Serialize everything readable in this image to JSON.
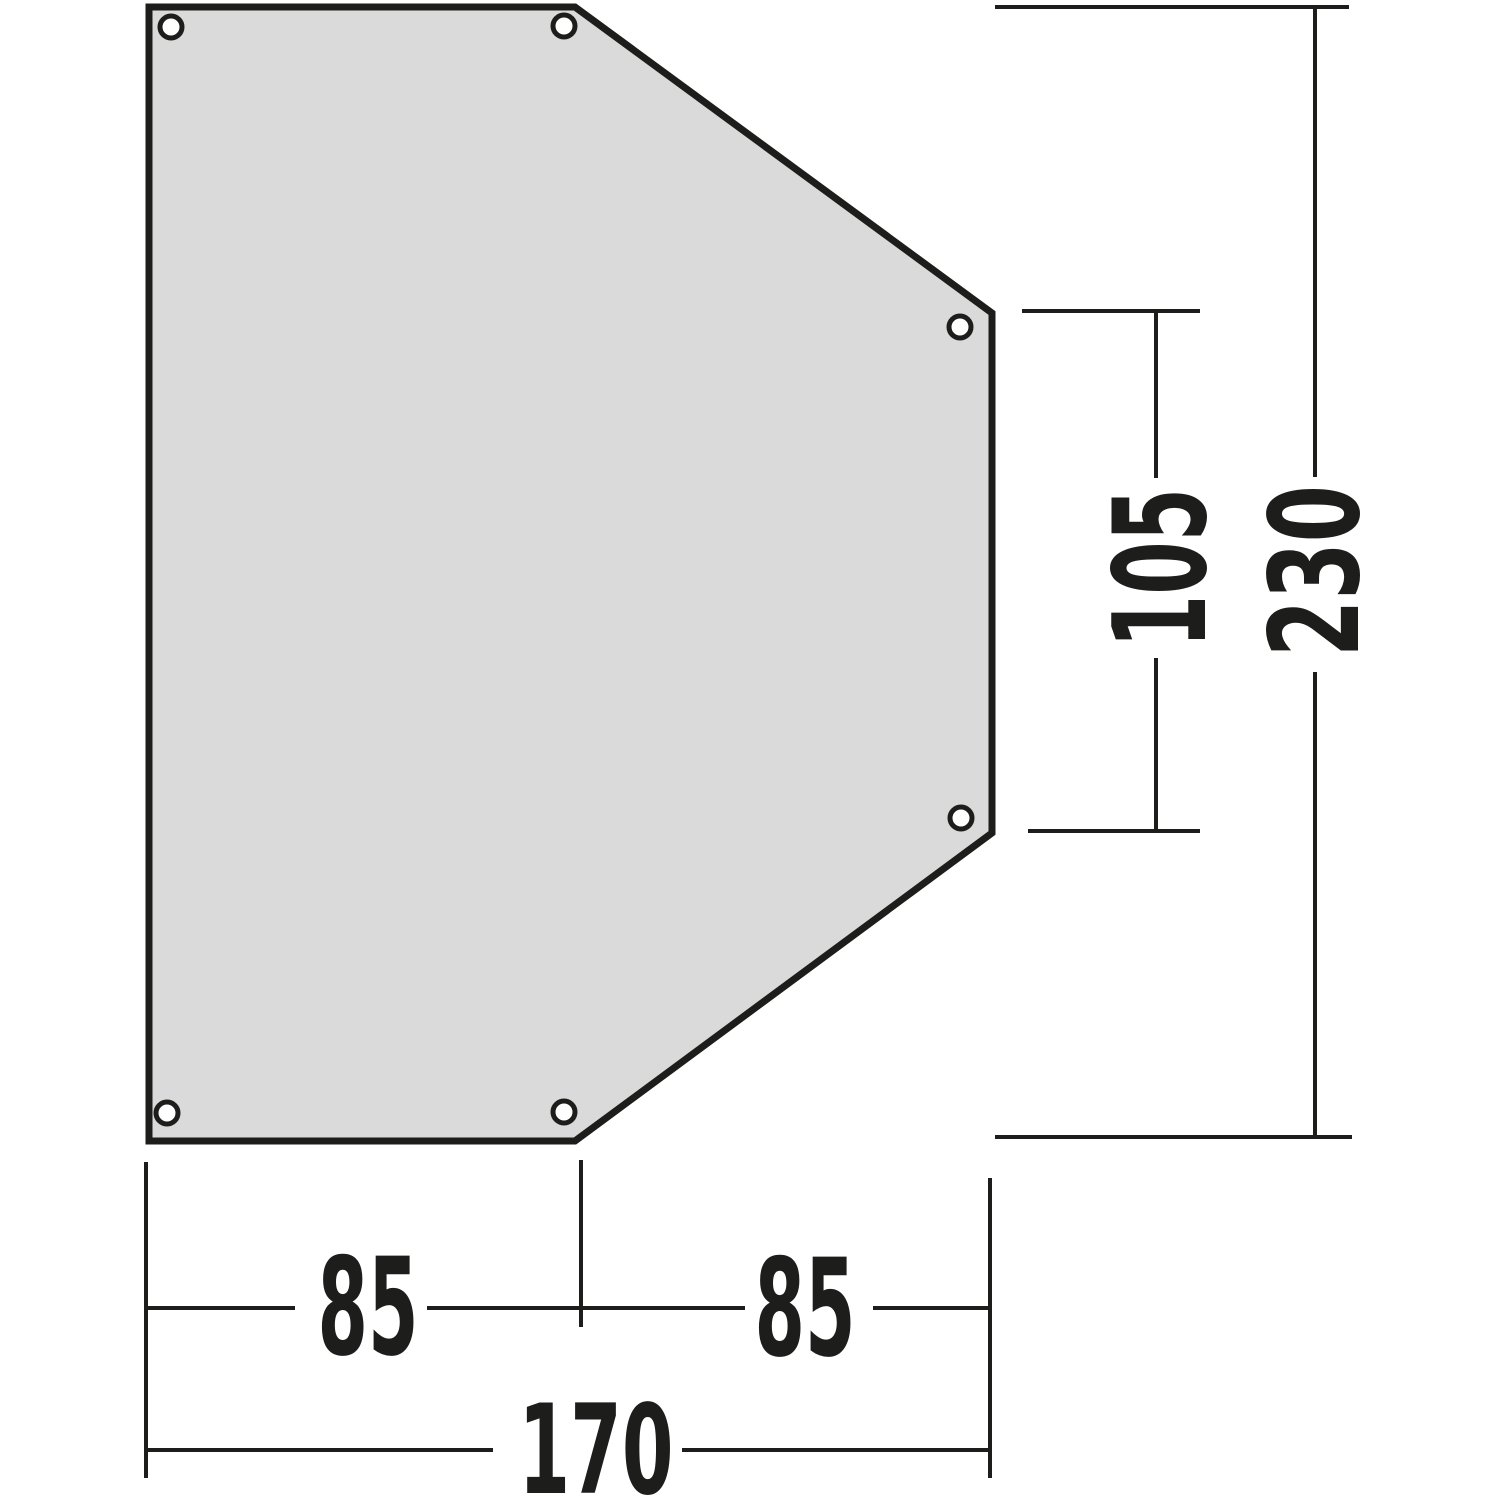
{
  "diagram": {
    "description": "Technical dimension drawing of a six-sided footprint/groundsheet panel with six corner grommets",
    "colors": {
      "background": "#ffffff",
      "panel_fill": "#dadada",
      "panel_stroke": "#1d1d1b",
      "dimension_line": "#1d1d1b",
      "label_text": "#1d1d1b",
      "grommet_fill": "#ffffff"
    },
    "dimensions": {
      "bottom_left_segment": "85",
      "bottom_right_segment": "85",
      "bottom_total": "170",
      "right_segment": "105",
      "right_total": "230"
    },
    "grommet_count": "6"
  }
}
